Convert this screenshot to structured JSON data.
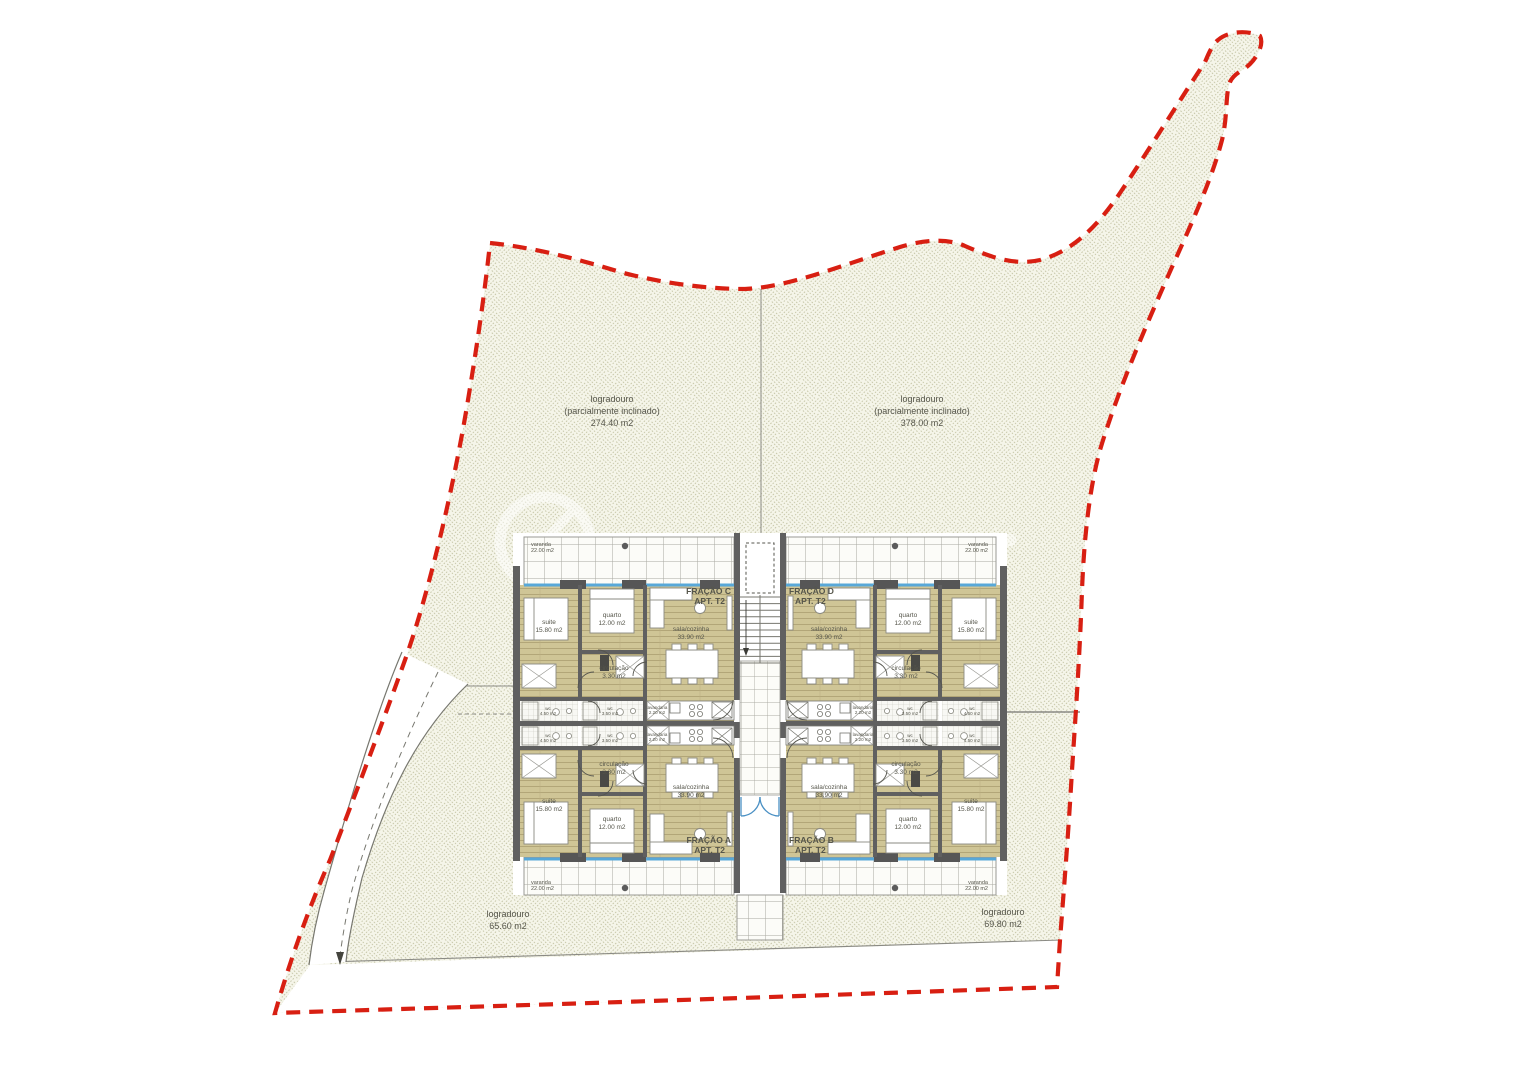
{
  "drawing": {
    "kind": "site-and-floor-plan",
    "boundary_color": "#d81f12",
    "floor_color": "#cfc596",
    "wall_color": "#606060",
    "window_color": "#58a8d8",
    "hatch_color": "#c6c6a8"
  },
  "site": {
    "rear_left": {
      "l1": "logradouro",
      "l2": "(parcialmente inclinado)",
      "l3": "274.40 m2"
    },
    "rear_right": {
      "l1": "logradouro",
      "l2": "(parcialmente inclinado)",
      "l3": "378.00 m2"
    },
    "front_left": {
      "l1": "logradouro",
      "l2": "65.60 m2"
    },
    "front_right": {
      "l1": "logradouro",
      "l2": "69.80 m2"
    }
  },
  "units": {
    "a": {
      "name": "FRAÇÃO A",
      "type": "APT. T2"
    },
    "b": {
      "name": "FRAÇÃO B",
      "type": "APT. T2"
    },
    "c": {
      "name": "FRAÇÃO C",
      "type": "APT. T2"
    },
    "d": {
      "name": "FRAÇÃO D",
      "type": "APT. T2"
    }
  },
  "rooms": {
    "suite": {
      "name": "suite",
      "area": "15.80 m2"
    },
    "quarto": {
      "name": "quarto",
      "area": "12.00 m2"
    },
    "sala": {
      "name": "sala/cozinha",
      "area": "33.90 m2"
    },
    "circulacao": {
      "name": "circulação",
      "area": "3.30 m2"
    },
    "wc_suite": {
      "name": "wc",
      "area": "4.50 m2"
    },
    "wc": {
      "name": "wc",
      "area": "3.50 m2"
    },
    "lavandaria": {
      "name": "lavandaria",
      "area": "2.20 m2"
    },
    "varanda": {
      "name": "varanda",
      "area": "22.00 m2"
    }
  }
}
